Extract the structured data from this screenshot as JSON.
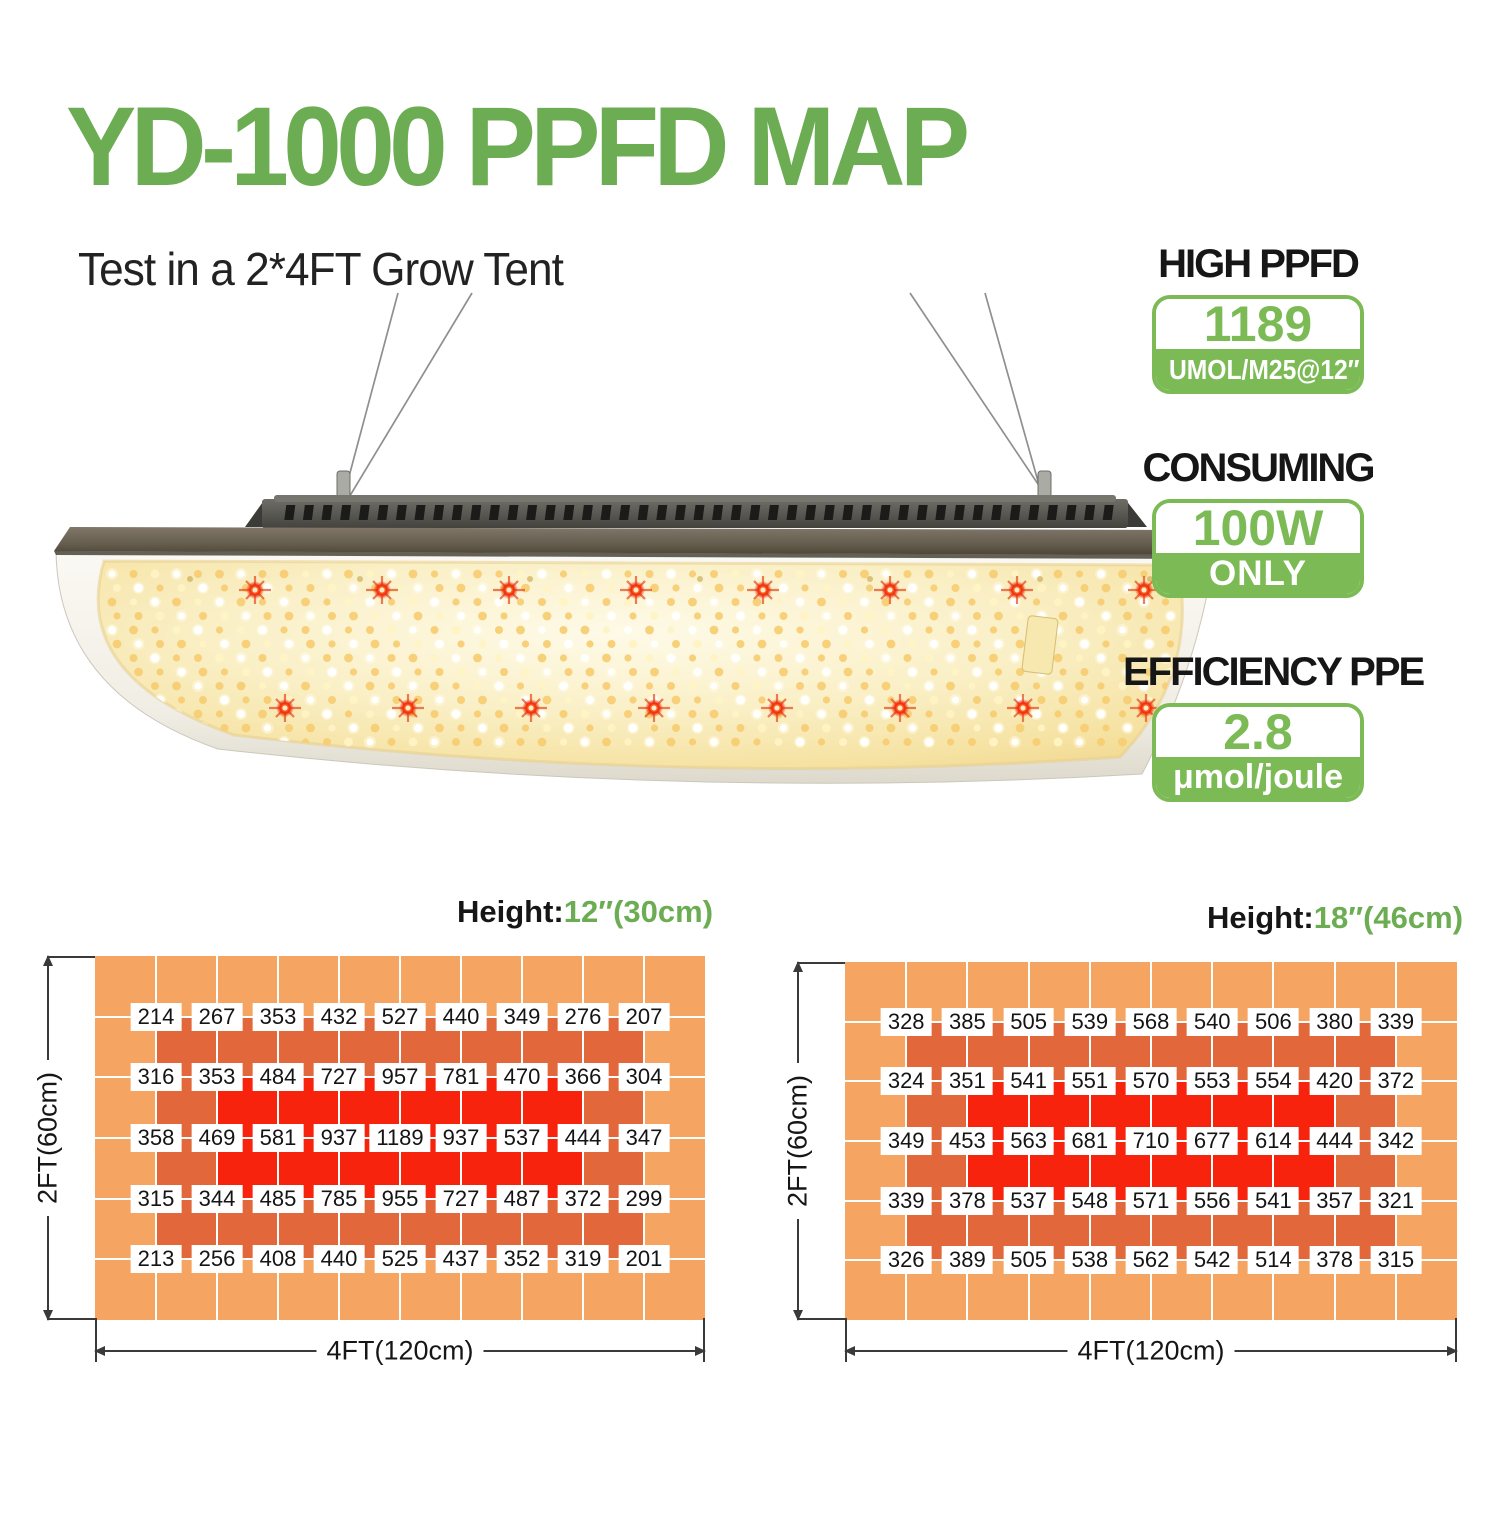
{
  "title": "YD-1000 PPFD MAP",
  "subtitle": "Test in a 2*4FT Grow Tent",
  "images": {
    "grow_light": "quantum-board LED grow light hanging on wires"
  },
  "colors": {
    "brand_green": "#6CAD53",
    "badge_green": "#7CBA55",
    "map_low": "#F5A561",
    "map_mid": "#E2673A",
    "map_high": "#F8230D"
  },
  "stats": [
    {
      "heading": "HIGH PPFD",
      "value": "1189",
      "unit": "UMOL/M25@12″"
    },
    {
      "heading": "CONSUMING",
      "value": "100W",
      "unit": "ONLY"
    },
    {
      "heading": "EFFICIENCY PPE",
      "value": "2.8",
      "unit": "μmol/joule"
    }
  ],
  "chart_data": [
    {
      "type": "heatmap",
      "title": "Height:12″(30cm)",
      "title_prefix": "Height:",
      "title_value": "12″(30cm)",
      "xlabel": "4FT(120cm)",
      "ylabel": "2FT(60cm)",
      "grid_cols": 10,
      "grid_rows": 6,
      "zones": {
        "mid": {
          "c0": 1,
          "r0": 1,
          "c1": 9,
          "r1": 5
        },
        "high": {
          "c0": 2,
          "r0": 2,
          "c1": 8,
          "r1": 4
        }
      },
      "values": [
        [
          214,
          267,
          353,
          432,
          527,
          440,
          349,
          276,
          207
        ],
        [
          316,
          353,
          484,
          727,
          957,
          781,
          470,
          366,
          304
        ],
        [
          358,
          469,
          581,
          937,
          1189,
          937,
          537,
          444,
          347
        ],
        [
          315,
          344,
          485,
          785,
          955,
          727,
          487,
          372,
          299
        ],
        [
          213,
          256,
          408,
          440,
          525,
          437,
          352,
          319,
          201
        ]
      ]
    },
    {
      "type": "heatmap",
      "title": "Height:18″(46cm)",
      "title_prefix": "Height:",
      "title_value": "18″(46cm)",
      "xlabel": "4FT(120cm)",
      "ylabel": "2FT(60cm)",
      "grid_cols": 10,
      "grid_rows": 6,
      "zones": {
        "mid": {
          "c0": 1,
          "r0": 1,
          "c1": 9,
          "r1": 5
        },
        "high": {
          "c0": 2,
          "r0": 2,
          "c1": 8,
          "r1": 4
        }
      },
      "values": [
        [
          328,
          385,
          505,
          539,
          568,
          540,
          506,
          380,
          339
        ],
        [
          324,
          351,
          541,
          551,
          570,
          553,
          554,
          420,
          372
        ],
        [
          349,
          453,
          563,
          681,
          710,
          677,
          614,
          444,
          342
        ],
        [
          339,
          378,
          537,
          548,
          571,
          556,
          541,
          357,
          321
        ],
        [
          326,
          389,
          505,
          538,
          562,
          542,
          514,
          378,
          315
        ]
      ]
    }
  ]
}
